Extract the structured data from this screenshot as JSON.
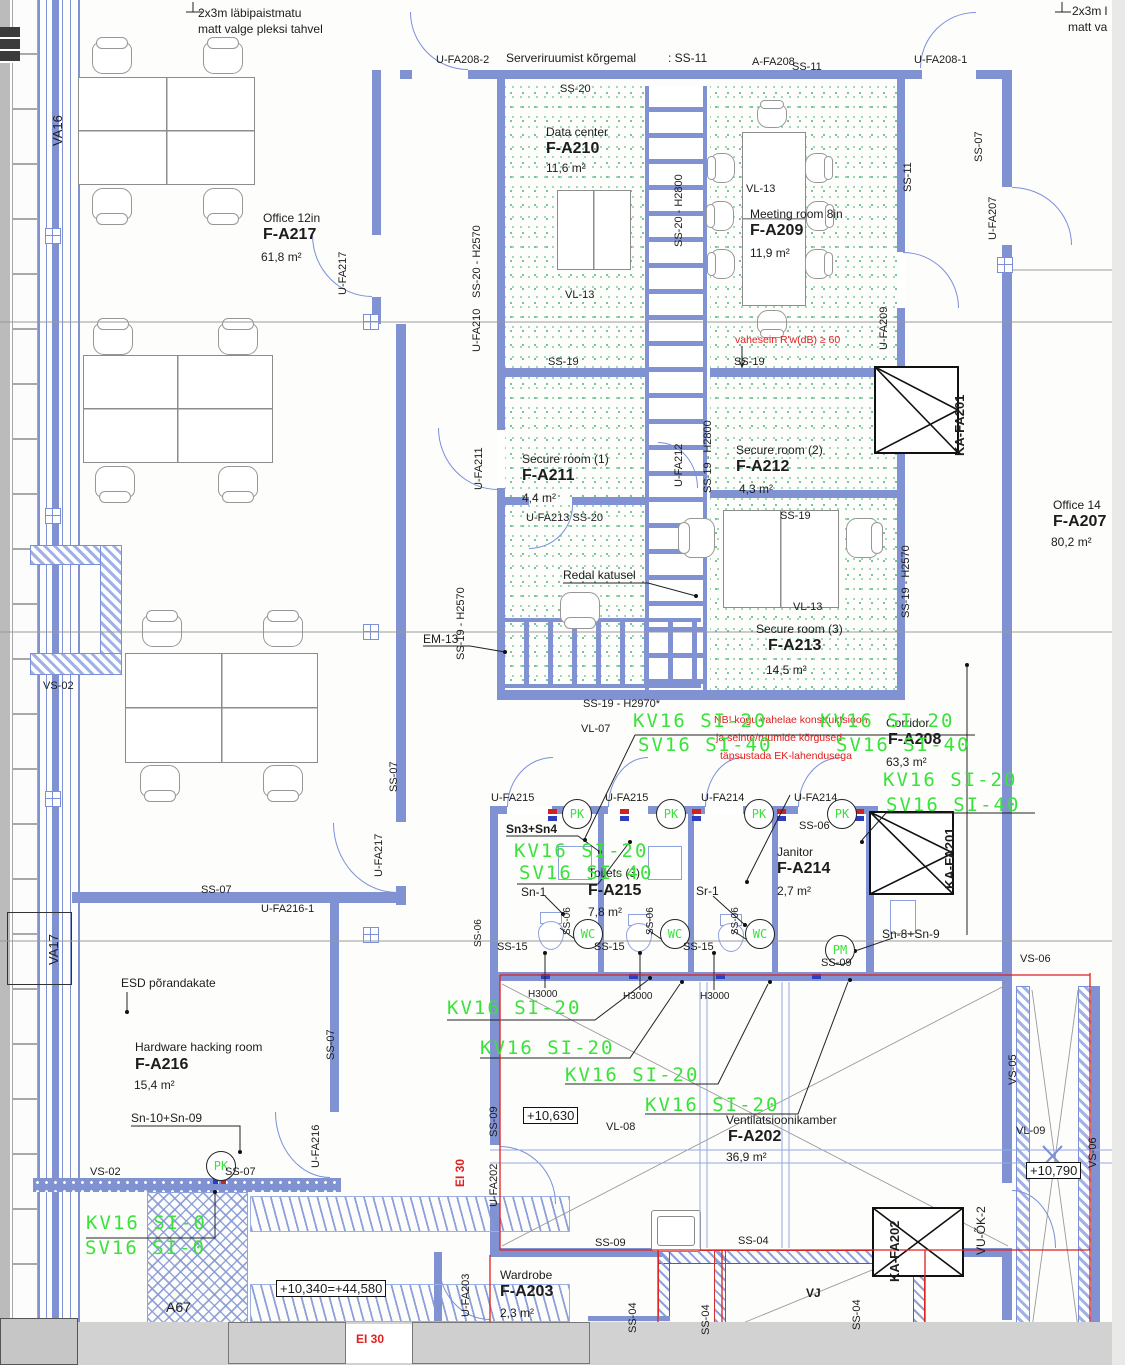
{
  "rooms": {
    "f_a217": {
      "name": "Office 12in",
      "code": "F-A217",
      "area": "61,8 m²"
    },
    "f_a210": {
      "name": "Data center",
      "code": "F-A210",
      "area": "11,6 m²"
    },
    "f_a209": {
      "name": "Meeting room 8in",
      "code": "F-A209",
      "area": "11,9 m²"
    },
    "f_a211": {
      "name": "Secure room (1)",
      "code": "F-A211",
      "area": "4,4 m²"
    },
    "f_a212": {
      "name": "Secure room (2)",
      "code": "F-A212",
      "area": "4,3 m²"
    },
    "f_a213": {
      "name": "Secure room (3)",
      "code": "F-A213",
      "area": "14,5 m²"
    },
    "f_a208": {
      "name": "Corridor",
      "code": "F-A208",
      "area": "63,3 m²"
    },
    "f_a215": {
      "name": "Toilets (3)",
      "code": "F-A215",
      "area": "7,8 m²"
    },
    "f_a214": {
      "name": "Janitor",
      "code": "F-A214",
      "area": "2,7 m²"
    },
    "f_a216": {
      "name": "Hardware hacking room",
      "code": "F-A216",
      "area": "15,4 m²"
    },
    "f_a202": {
      "name": "Ventilatsioonikamber",
      "code": "F-A202",
      "area": "36,9 m²"
    },
    "f_a203": {
      "name": "Wardrobe",
      "code": "F-A203",
      "area": "2,3 m²"
    },
    "f_a207": {
      "name": "Office 14",
      "code": "F-A207",
      "area": "80,2 m²"
    }
  },
  "wall_codes": {
    "ss04": "SS-04",
    "ss06": "SS-06",
    "ss07": "SS-07",
    "ss09": "SS-09",
    "ss11": "SS-11",
    "ss15": "SS-15",
    "ss19": "SS-19",
    "ss20": "SS-20",
    "h3000": "H3000",
    "em13": "EM-13",
    "vs02": "VS-02",
    "vs05": "VS-05",
    "vs06": "VS-06",
    "va16": "VA16",
    "va17": "VA17",
    "vl07": "VL-07",
    "vl08": "VL-08",
    "vl09": "VL-09",
    "vl13": "VL-13",
    "a67": "A67",
    "vj": "VJ",
    "vu_ok2": "VU-ÕK-2",
    "ss19_h2570": "SS-19 - H2570",
    "ss19_h2800": "SS-19 - H2800",
    "ss19_h2970": "SS-19 - H2970*",
    "ss20_h2570": "SS-20 - H2570",
    "ss20_h2800": "SS-20 - H2800"
  },
  "openings": {
    "u_fa202": "U-FA202",
    "u_fa203": "U-FA203",
    "u_fa207": "U-FA207",
    "u_fa208_1": "U-FA208-1",
    "u_fa208_2": "U-FA208-2",
    "a_fa208": "A-FA208",
    "u_fa209": "U-FA209",
    "u_fa210": "U-FA210",
    "u_fa211": "U-FA211",
    "u_fa212": "U-FA212",
    "u_fa213_ss20": "U-FA213 SS-20",
    "u_fa214": "U-FA214",
    "u_fa215": "U-FA215",
    "u_fa216": "U-FA216",
    "u_fa216_1": "U-FA216-1",
    "u_fa217": "U-FA217",
    "ka_fa201": "KA-FA201",
    "ka_fa202": "KA-FA202"
  },
  "green_marks": {
    "kv16_si20": "KV16 SI-20",
    "sv16_si40": "SV16 SI-40",
    "kv16_si0": "KV16 SI-0",
    "sv16_si0": "SV16 SI-0",
    "pk": "PK",
    "wc": "WC",
    "pm": "PM"
  },
  "sanitary": {
    "sn3_sn4": "Sn3+Sn4",
    "sn1": "Sn-1",
    "sr1": "Sr-1",
    "sn8_sn9": "Sn-8+Sn-9",
    "sn10_sn09": "Sn-10+Sn-09"
  },
  "notes": {
    "plexi1": "2x3m läbipaistmatu",
    "plexi2": "matt valge pleksi tahvel",
    "plexi_r1": "2x3m l",
    "plexi_r2": "matt va",
    "server": "Serveriruumist kõrgemal",
    "server_code": ": SS-11",
    "nb1": "NB! kogu vahelae konstruktsioon",
    "nb2": "ja seinte/ruumide kõrgused",
    "nb3": "täpsustada EK-lahendusega",
    "vahesein": "vahesein R'w(dB) ≥ 60",
    "esd": "ESD põrandakate",
    "redal": "Redal katusel",
    "ei30": "EI 30"
  },
  "levels": {
    "vent": "+10,630",
    "shaft": "+10,790",
    "ground": "+10,340=+44,580"
  },
  "colors": {
    "wall_blue": "#8092d2",
    "cad_green": "#3be23b",
    "note_red": "#e02020",
    "stipple_green": "#6fbf92"
  }
}
